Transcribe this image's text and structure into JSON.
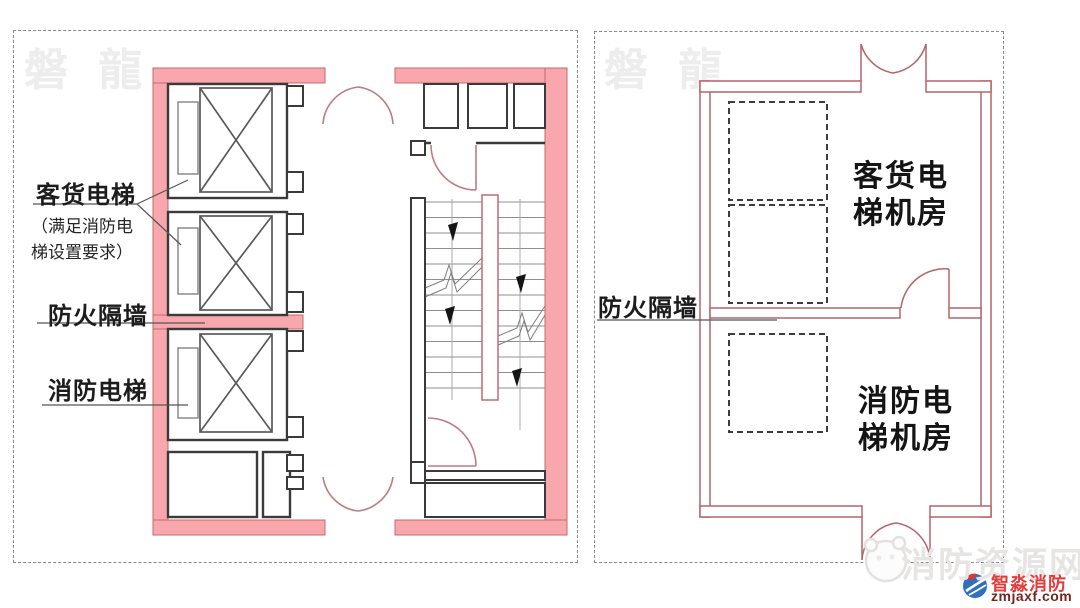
{
  "left_panel": {
    "watermark": "磐 龍",
    "labels": {
      "freight_elevator": "客货电梯",
      "freight_elevator_note_line1": "（满足消防电",
      "freight_elevator_note_line2": "梯设置要求）",
      "fire_partition_wall": "防火隔墙",
      "fire_elevator": "消防电梯"
    }
  },
  "right_panel": {
    "watermark": "磐 龍",
    "labels": {
      "fire_partition_wall": "防火隔墙",
      "freight_machine_room_line1": "客货电",
      "freight_machine_room_line2": "梯机房",
      "fire_machine_room_line1": "消防电",
      "fire_machine_room_line2": "梯机房"
    }
  },
  "footer": {
    "site_watermark": "消防资源网",
    "brand_name": "智淼消防",
    "brand_domain": "zmjaxf.com"
  },
  "colors": {
    "fire_wall_fill": "#f8a7ac",
    "fire_wall_border": "#c4696f",
    "thin_wall_red": "#b4656b",
    "black_wall": "#3a3a3a",
    "door_arc": "#bb7d81",
    "brand_red": "#e23c3c",
    "brand_domain_red": "#75261f"
  }
}
